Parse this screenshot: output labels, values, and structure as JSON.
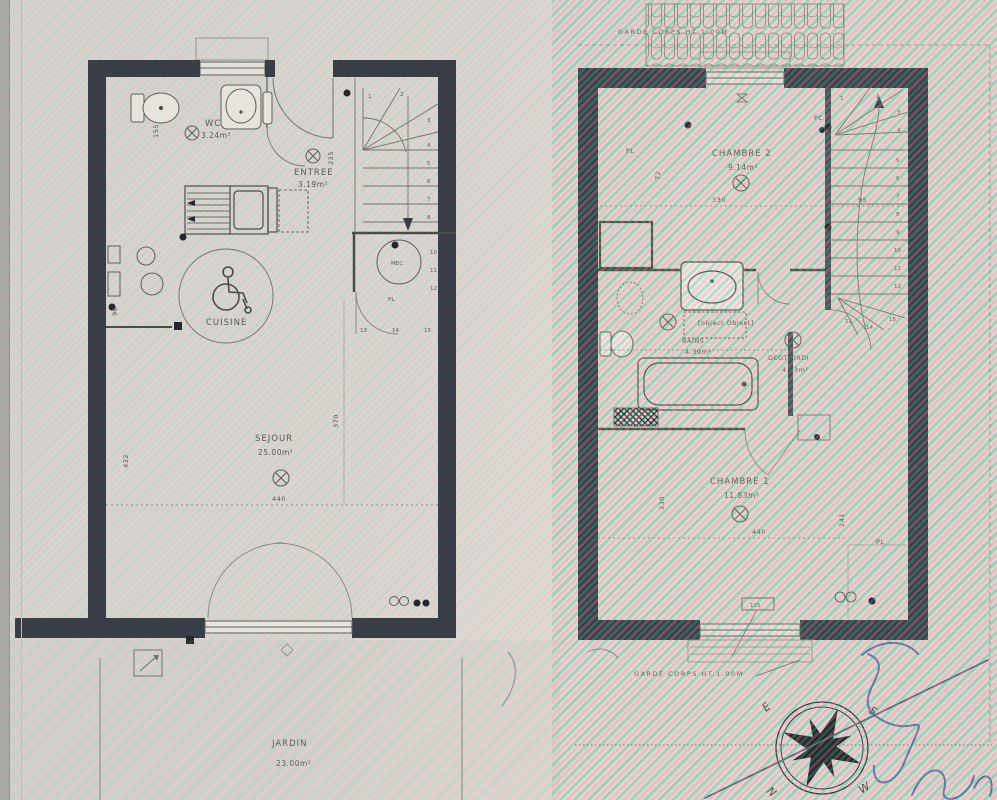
{
  "document": {
    "type": "scanned architectural floor plan photo",
    "floors": [
      "ground floor",
      "first floor"
    ]
  },
  "left_plan": {
    "wc": {
      "label": "WC",
      "area": "3.24m²"
    },
    "entree": {
      "label": "ENTREE",
      "area": "3.19m²"
    },
    "cuisine": {
      "label": "CUISINE"
    },
    "sejour": {
      "label": "SEJOUR",
      "area": "25.00m²"
    },
    "jardin": {
      "label": "JARDIN",
      "area": "23.00m²"
    },
    "mec": {
      "label": "MEC"
    },
    "pl": {
      "label": "PL"
    },
    "dims": {
      "wc_h": "155",
      "entree_h": "225",
      "sejour_w": "440",
      "sejour_h": "432",
      "hall_h": "370",
      "kitchen_w": "96"
    },
    "stair_numbers": [
      "1",
      "2",
      "3",
      "4",
      "5",
      "6",
      "7",
      "8"
    ],
    "landing_numbers": [
      "13",
      "14",
      "15"
    ],
    "right_column_numbers": [
      "10",
      "11",
      "12"
    ]
  },
  "right_plan": {
    "chambre2": {
      "label": "CHAMBRE 2",
      "area": "9.14m²"
    },
    "chambre1": {
      "label": "CHAMBRE 1",
      "area": "11.83m²"
    },
    "bains": {
      "label": "BAINS",
      "area": "4.39m²"
    },
    "velux": {
      "label": "VELUX"
    },
    "degt": {
      "label": "DEGT/ORDI",
      "area": "4.53m²"
    },
    "pl_top": "PL",
    "pl_bottom": "PL",
    "pc": "PC",
    "garde_corps_top": "GARDE CORPS HT 1.00M",
    "garde_corps_bottom": "GARDE CORPS HT.1.00M",
    "window_tag": "115",
    "dims": {
      "chambre2_w": "330",
      "stair_w": "95",
      "chambre2_h": "72",
      "chambre1_w": "440",
      "chambre1_h_left": "330",
      "chambre1_h_right": "241"
    },
    "stair_numbers": [
      "1",
      "2",
      "3",
      "4",
      "5",
      "6",
      "7",
      "8",
      "9",
      "10",
      "11",
      "12",
      "13",
      "14",
      "15"
    ]
  },
  "compass": {
    "n": "N",
    "s": "S",
    "e": "E",
    "w": "W"
  },
  "icons": {
    "wheelchair": "wheelchair-accessibility-icon",
    "ceiling_light": "circle-cross light point",
    "compass": "8-point compass rose",
    "toilet": "toilet plan symbol",
    "washbasin": "washbasin plan symbol",
    "bathtub": "bathtub plan symbol"
  },
  "colors": {
    "wall": "#383d48",
    "line": "#6d7168",
    "text": "#565b50",
    "ink_blue": "#4060a8",
    "moire_teal": "#4ab696",
    "moire_pink": "#ee94a0",
    "paper": "#d8d5cf"
  }
}
